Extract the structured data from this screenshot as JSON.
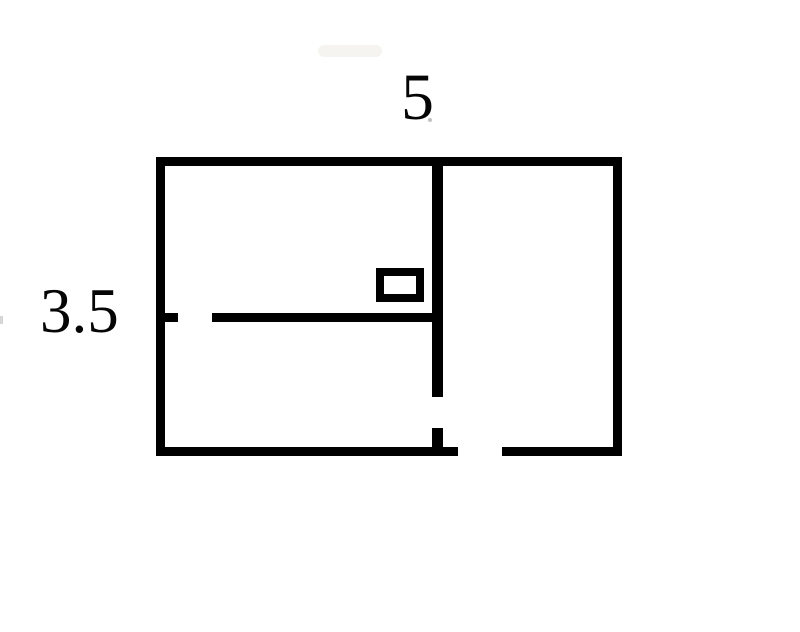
{
  "diagram": {
    "type": "floor-plan",
    "description": "Rectangle divided by an interior vertical wall and an interior horizontal wall, with doorway gaps and a small rectangle symbol",
    "background_color": "#ffffff",
    "wall_color": "#000000",
    "labels": {
      "width": {
        "text": "5",
        "position": "top-center"
      },
      "height": {
        "text": "3.5",
        "position": "middle-left"
      }
    }
  }
}
